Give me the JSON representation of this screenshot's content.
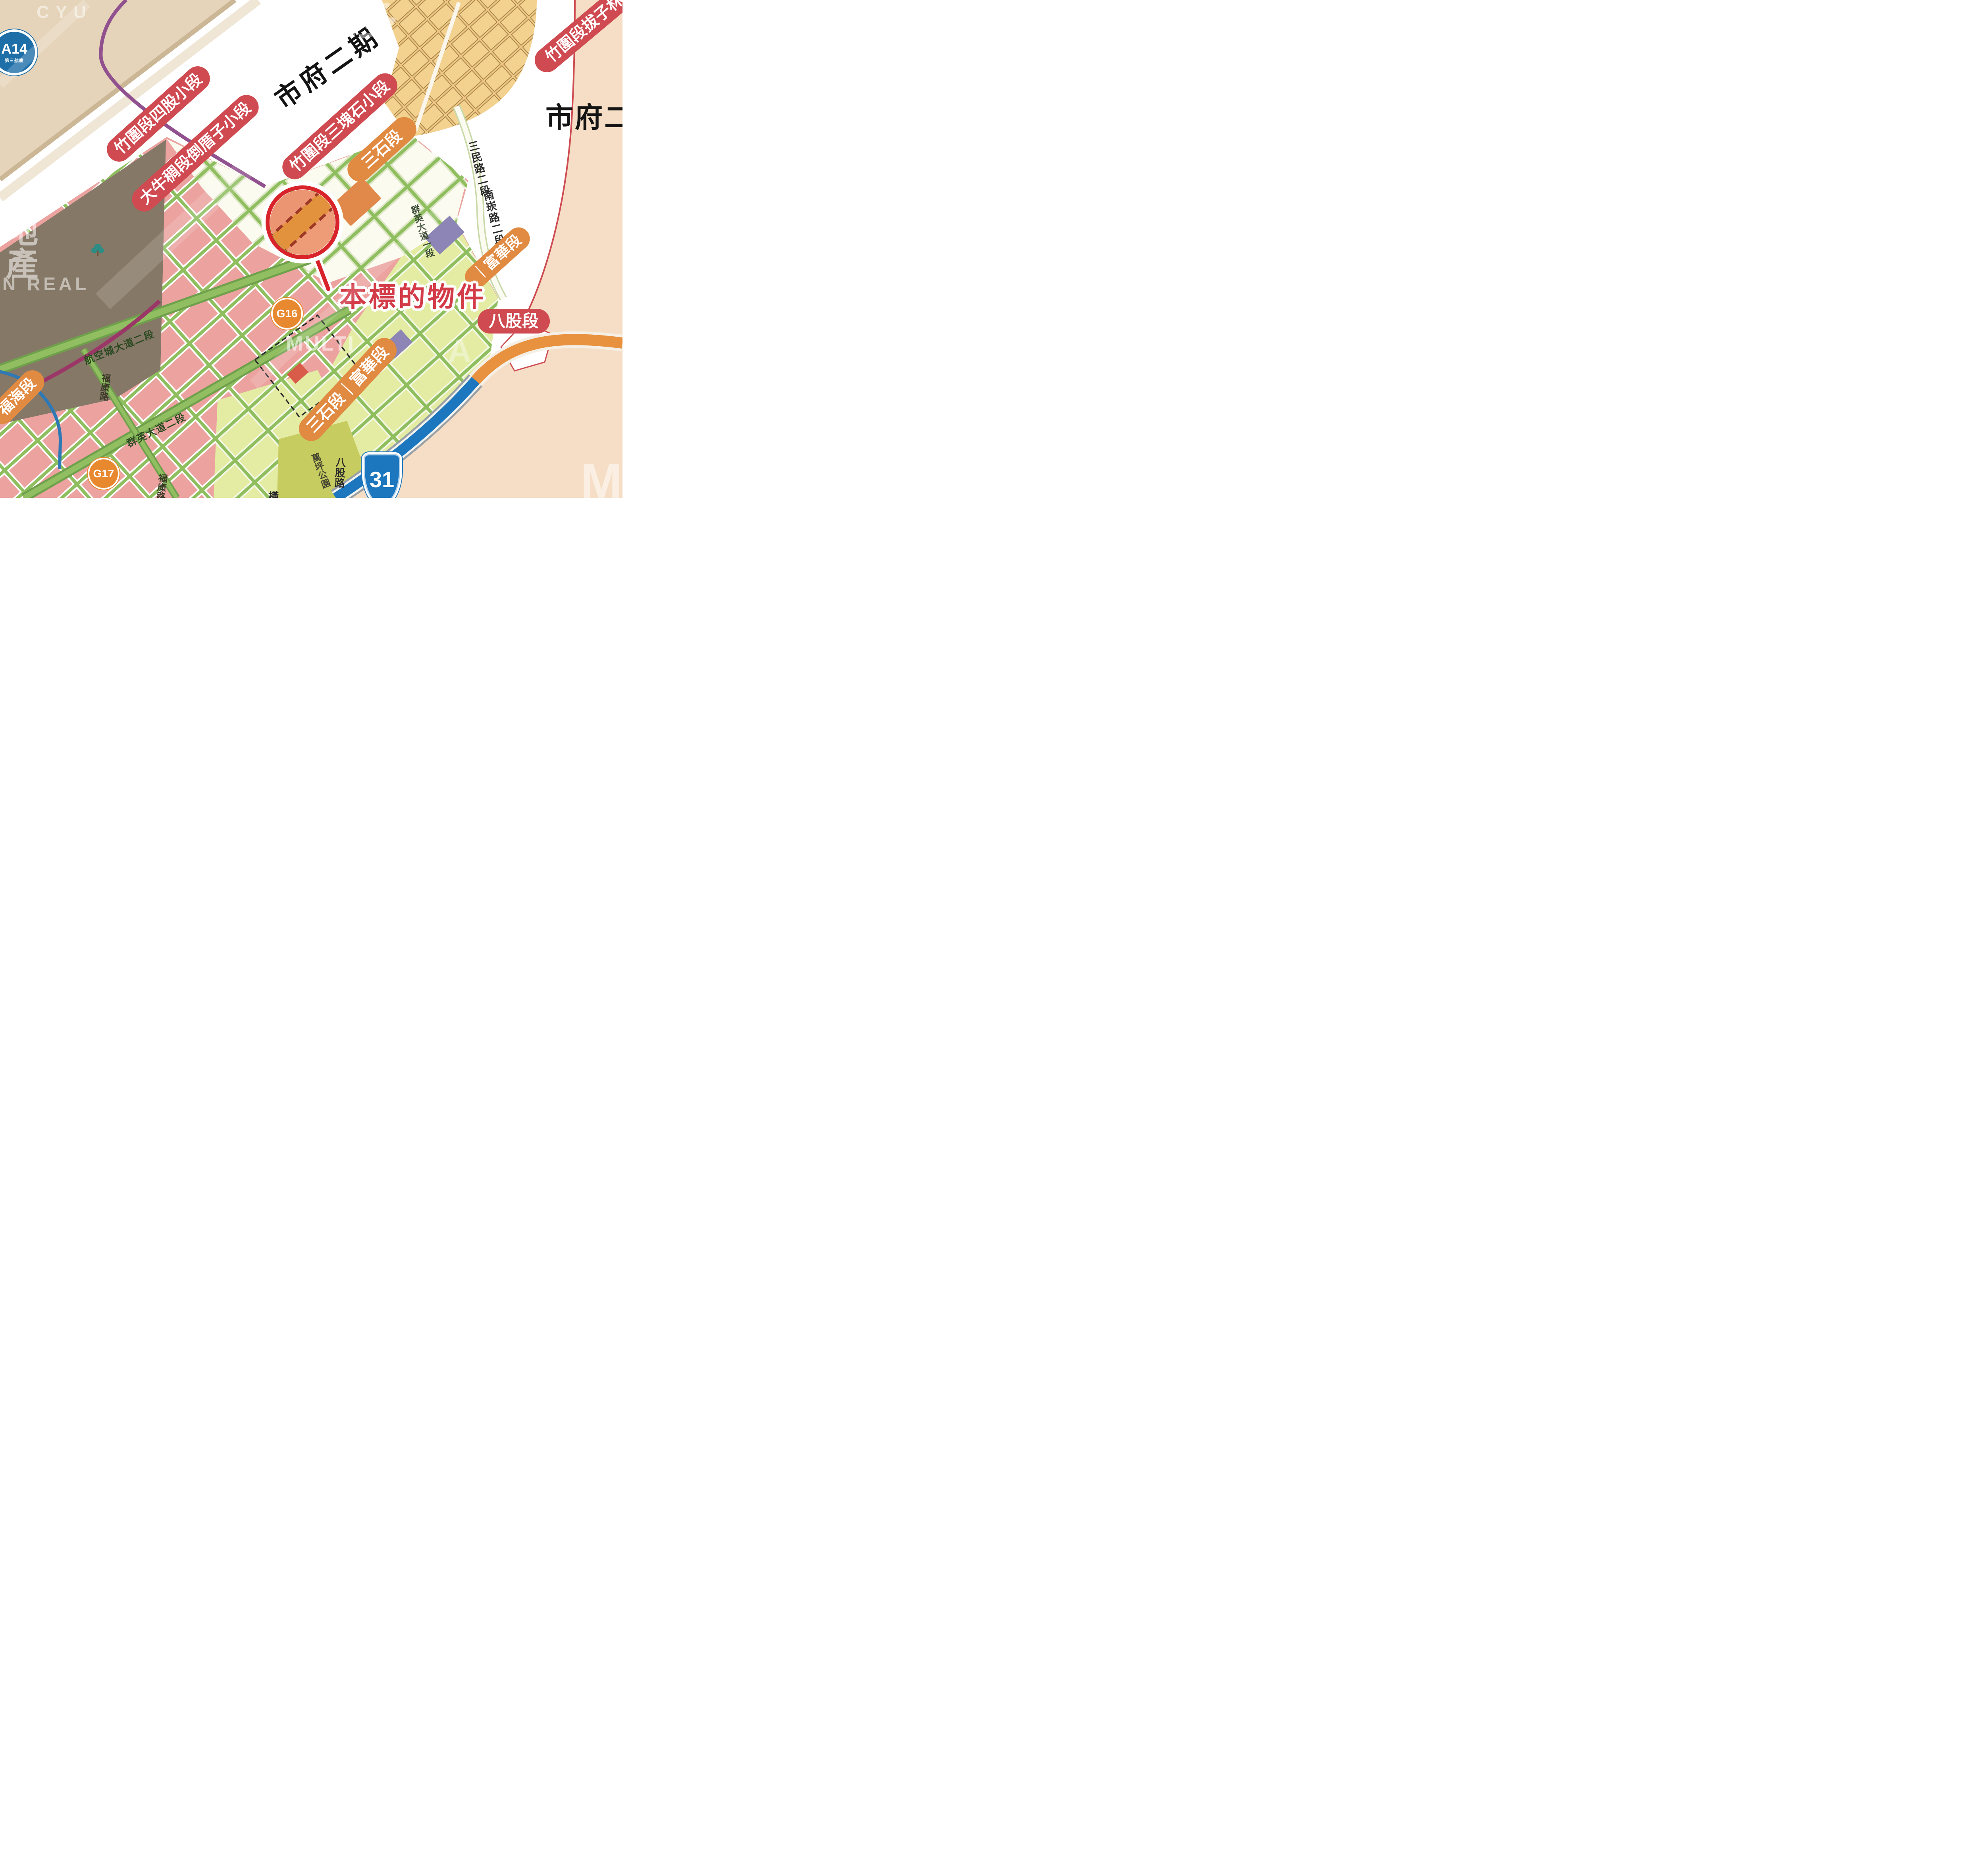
{
  "map_texts": {
    "district_band": "市府二期",
    "district_right": "市府二",
    "target": "本標的物件",
    "partial_road_char": "橫"
  },
  "stations": {
    "a14": {
      "code": "A14",
      "sub": "第三航廈"
    },
    "g16": {
      "code": "G16"
    },
    "g17": {
      "code": "G17"
    },
    "highway31": {
      "code": "31"
    }
  },
  "pills": [
    {
      "id": "zhuwei-sigu",
      "label": "竹圍段四股小段",
      "color": "#CF4A51"
    },
    {
      "id": "daniuchou",
      "label": "大牛稠段倒厝子小段",
      "color": "#CF4A51"
    },
    {
      "id": "zhuwei-sankuaishi",
      "label": "竹圍段三塊石小段",
      "color": "#CF4A51"
    },
    {
      "id": "sanshi",
      "label": "三石段",
      "color": "#E18A42"
    },
    {
      "id": "zhuwei-bazilin",
      "label": "竹圍段拔子林",
      "color": "#CF4A51"
    },
    {
      "id": "fuhua-right",
      "label": "｜富華段",
      "color": "#E18A42"
    },
    {
      "id": "bagu",
      "label": "八股段",
      "color": "#CF4A51"
    },
    {
      "id": "sanshi-fuhua",
      "label": "三石段｜富華段",
      "color": "#E18A42"
    },
    {
      "id": "fuhai",
      "label": "福海段",
      "color": "#E18A42"
    }
  ],
  "road_labels": [
    "三民路二段",
    "南崁路二段",
    "群英大道一段",
    "航空城大道二段",
    "福康路",
    "群英大道二段",
    "福康路",
    "八股路"
  ],
  "park_label": "萬坪公園",
  "watermarks": [
    "CYU",
    "哇立多",
    "地產",
    "N REAL",
    "MULTI",
    "A",
    "M"
  ],
  "colors": {
    "pill_red": "#CF4A51",
    "pill_orange": "#E18A42",
    "target_red": "#D23B47",
    "mrt_purple": "#91518F",
    "mrt_magenta": "#9B3767",
    "station_blue": "#1E6FA8",
    "station_orange": "#E8892F",
    "highway_blue": "#1C77BE",
    "highway_orange": "#E8923F",
    "road_green": "#8FBE5F",
    "parcel_pink": "#ECA3A0",
    "parcel_yellow": "#E3ECA2",
    "terminal_khaki": "#867867",
    "band_beige": "#E5D4B9",
    "zone_tan": "#EFC884",
    "area_peach": "#F5DEC5",
    "magnifier_red": "#D8232A",
    "property_orange": "#E2913C"
  }
}
